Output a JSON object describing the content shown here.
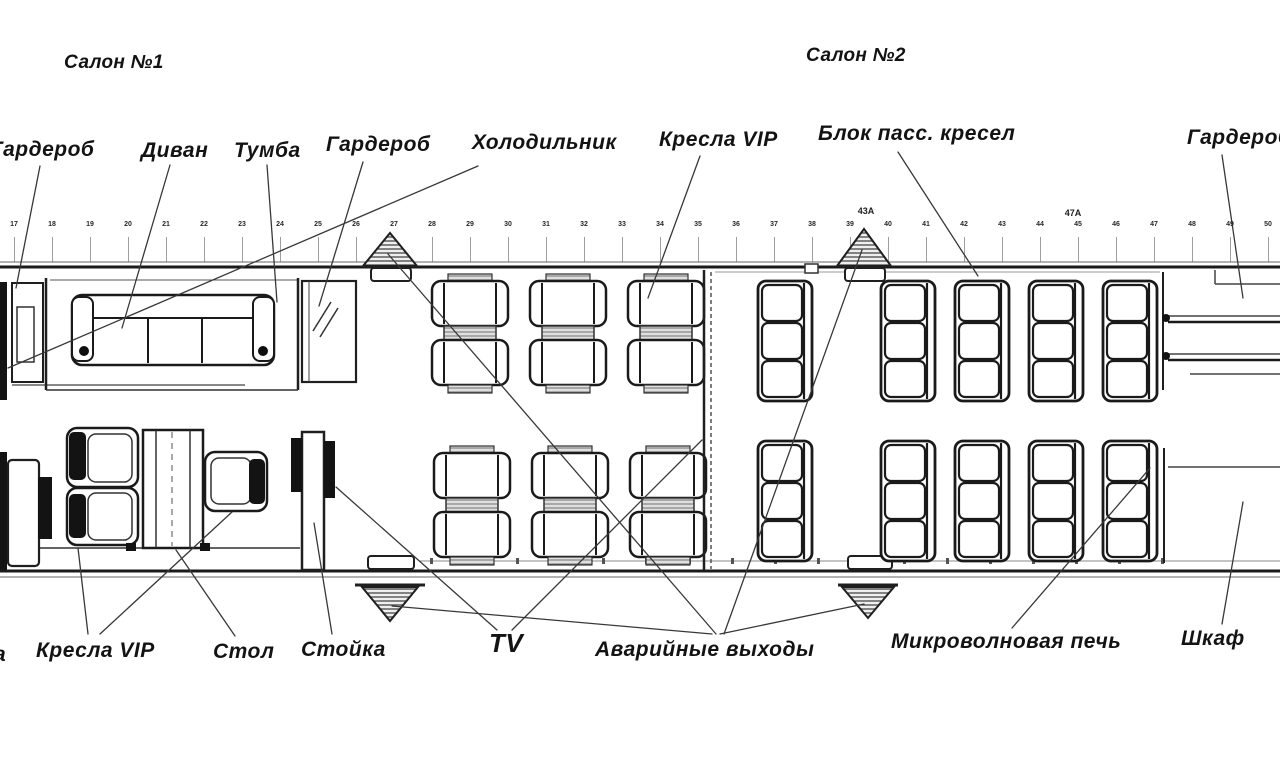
{
  "salon1_title": "Салон №1",
  "salon2_title": "Салон №2",
  "labels": {
    "top": [
      {
        "id": "wardrobe-front",
        "text": "Гардероб"
      },
      {
        "id": "sofa",
        "text": "Диван"
      },
      {
        "id": "cabinet",
        "text": "Тумба"
      },
      {
        "id": "wardrobe-2",
        "text": "Гардероб"
      },
      {
        "id": "refrigerator",
        "text": "Холодильник"
      },
      {
        "id": "vip-seats",
        "text": "Кресла VIP"
      },
      {
        "id": "pax-seat-block",
        "text": "Блок пасс. кресел"
      },
      {
        "id": "wardrobe-rear",
        "text": "Гардероб"
      }
    ],
    "bottom": [
      {
        "id": "vip-seats-2",
        "text": "Кресла VIP"
      },
      {
        "id": "table",
        "text": "Стол"
      },
      {
        "id": "counter",
        "text": "Стойка"
      },
      {
        "id": "tv",
        "text": "TV"
      },
      {
        "id": "emergency-exits",
        "text": "Аварийные выходы"
      },
      {
        "id": "microwave",
        "text": "Микроволновая печь"
      },
      {
        "id": "cupboard",
        "text": "Шкаф"
      }
    ],
    "left_fragment": "а"
  },
  "frame_numbers": [
    "17",
    "18",
    "19",
    "20",
    "21",
    "22",
    "23",
    "24",
    "25",
    "26",
    "27",
    "28",
    "29",
    "30",
    "31",
    "32",
    "33",
    "34",
    "35",
    "36",
    "37",
    "38",
    "39",
    "40",
    "41",
    "42",
    "43",
    "44",
    "45",
    "46",
    "47",
    "48",
    "49",
    "50"
  ],
  "frame_special": [
    {
      "text": "43А"
    },
    {
      "text": "47А"
    }
  ],
  "colors": {
    "ink": "#161616",
    "line": "#3a3a3a",
    "light_line": "#888888"
  }
}
